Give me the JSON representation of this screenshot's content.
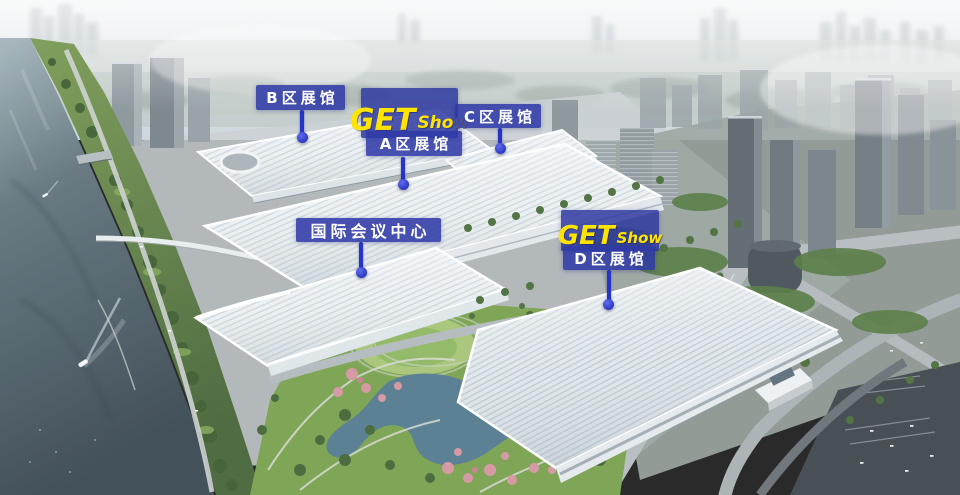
{
  "annotations": {
    "hall_b": {
      "label": "B区展馆"
    },
    "hall_a": {
      "label": "A区展馆"
    },
    "hall_c": {
      "label": "C区展馆"
    },
    "hall_d": {
      "label": "D区展馆"
    },
    "conference_center": {
      "label": "国际会议中心"
    },
    "logo": {
      "main": "GET",
      "sub": "Show"
    }
  },
  "colors": {
    "annotation_blue": "#3340A8",
    "logo_yellow": "#FFE400",
    "pointer_blue": "#2635C8",
    "river_dark": "#3C4A54",
    "roof_white": "#EDF1F3",
    "park_green": "#7AA351"
  }
}
